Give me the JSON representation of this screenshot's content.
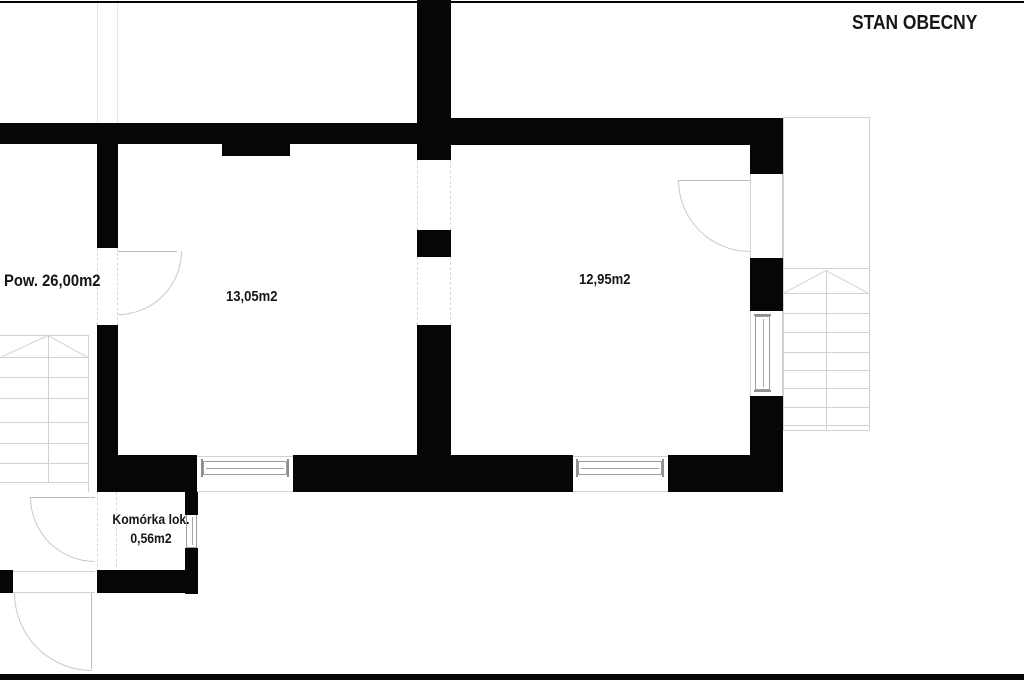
{
  "title": "STAN OBECNY",
  "annotations": {
    "exterior_area": "Pow. 26,00m2"
  },
  "rooms": {
    "left": {
      "area": "13,05m2"
    },
    "right": {
      "area": "12,95m2"
    },
    "storage": {
      "name": "Komórka lok.",
      "area": "0,56m2"
    }
  },
  "colors": {
    "wall": "#060606",
    "thin_line": "#d2d2d2",
    "background": "#ffffff"
  }
}
